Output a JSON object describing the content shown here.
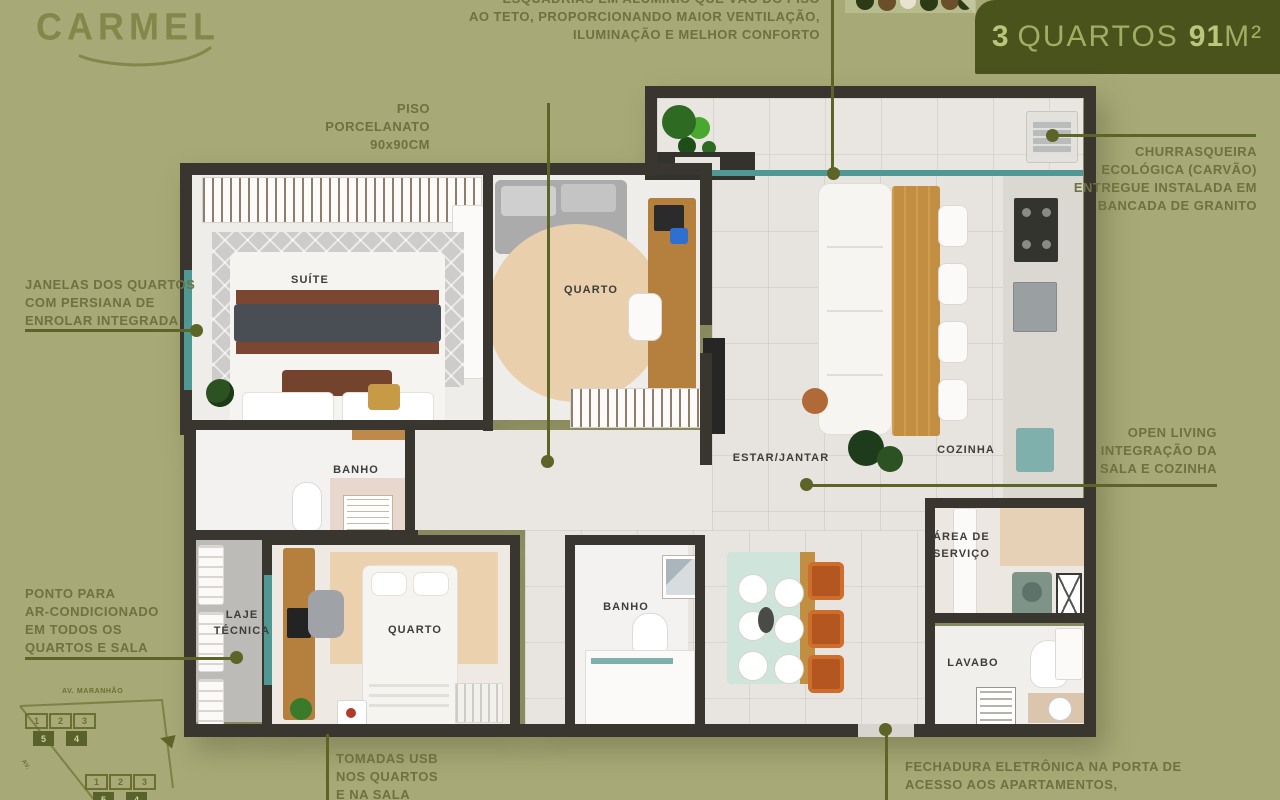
{
  "logo": {
    "text": "CARMEL"
  },
  "badge": {
    "count": "3",
    "rooms": "QUARTOS",
    "area": "91",
    "unit": "M²"
  },
  "annotations": {
    "esquadrias": {
      "lines": [
        "ESQUADRIAS EM ALUMÍNIO QUE VÃO DO PISO",
        "AO TETO, PROPORCIONANDO MAIOR VENTILAÇÃO,",
        "ILUMINAÇÃO E MELHOR CONFORTO"
      ]
    },
    "piso": {
      "lines": [
        "PISO",
        "PORCELANATO",
        "90x90CM"
      ]
    },
    "janelas": {
      "lines": [
        "JANELAS DOS QUARTOS",
        "COM PERSIANA DE",
        "ENROLAR INTEGRADA"
      ]
    },
    "churrasqueira": {
      "lines": [
        "CHURRASQUEIRA",
        "ECOLÓGICA (CARVÃO)",
        "ENTREGUE INSTALADA EM",
        "BANCADA DE GRANITO"
      ]
    },
    "open_living": {
      "lines": [
        "OPEN LIVING",
        "INTEGRAÇÃO DA",
        "SALA E COZINHA"
      ]
    },
    "ponto": {
      "lines": [
        "PONTO PARA",
        "AR-CONDICIONADO",
        "EM TODOS OS",
        "QUARTOS E SALA"
      ]
    },
    "tomadas": {
      "lines": [
        "TOMADAS USB",
        "NOS QUARTOS",
        "E NA SALA"
      ]
    },
    "fechadura": {
      "lines": [
        "FECHADURA ELETRÔNICA NA PORTA DE",
        "ACESSO AOS APARTAMENTOS,"
      ]
    }
  },
  "plan_labels": {
    "suite": "SUÍTE",
    "bedroom_top": "QUARTO",
    "bathroom_1": "BANHO",
    "living": "ESTAR/JANTAR",
    "kitchen": "COZINHA",
    "service_line1": "ÁREA DE",
    "service_line2": "SERVIÇO",
    "technical_line1": "LAJE",
    "technical_line2": "TÉCNICA",
    "bedroom_bottom": "QUARTO",
    "bathroom_2": "BANHO",
    "lavatory": "LAVABO"
  },
  "keyplan": {
    "street": "AV. MARANHÃO",
    "street_side": "AV.",
    "top_row1": [
      "1",
      "2",
      "3"
    ],
    "top_row2": [
      "5",
      "4"
    ],
    "bottom_row1": [
      "1",
      "2",
      "3"
    ],
    "bottom_row2": [
      "5",
      "4"
    ]
  },
  "colors": {
    "background": "#a7a976",
    "accent_leader": "#5c6428",
    "badge_bg": "#4b531d",
    "wall": "#38362f",
    "window_teal": "#4f9894"
  }
}
